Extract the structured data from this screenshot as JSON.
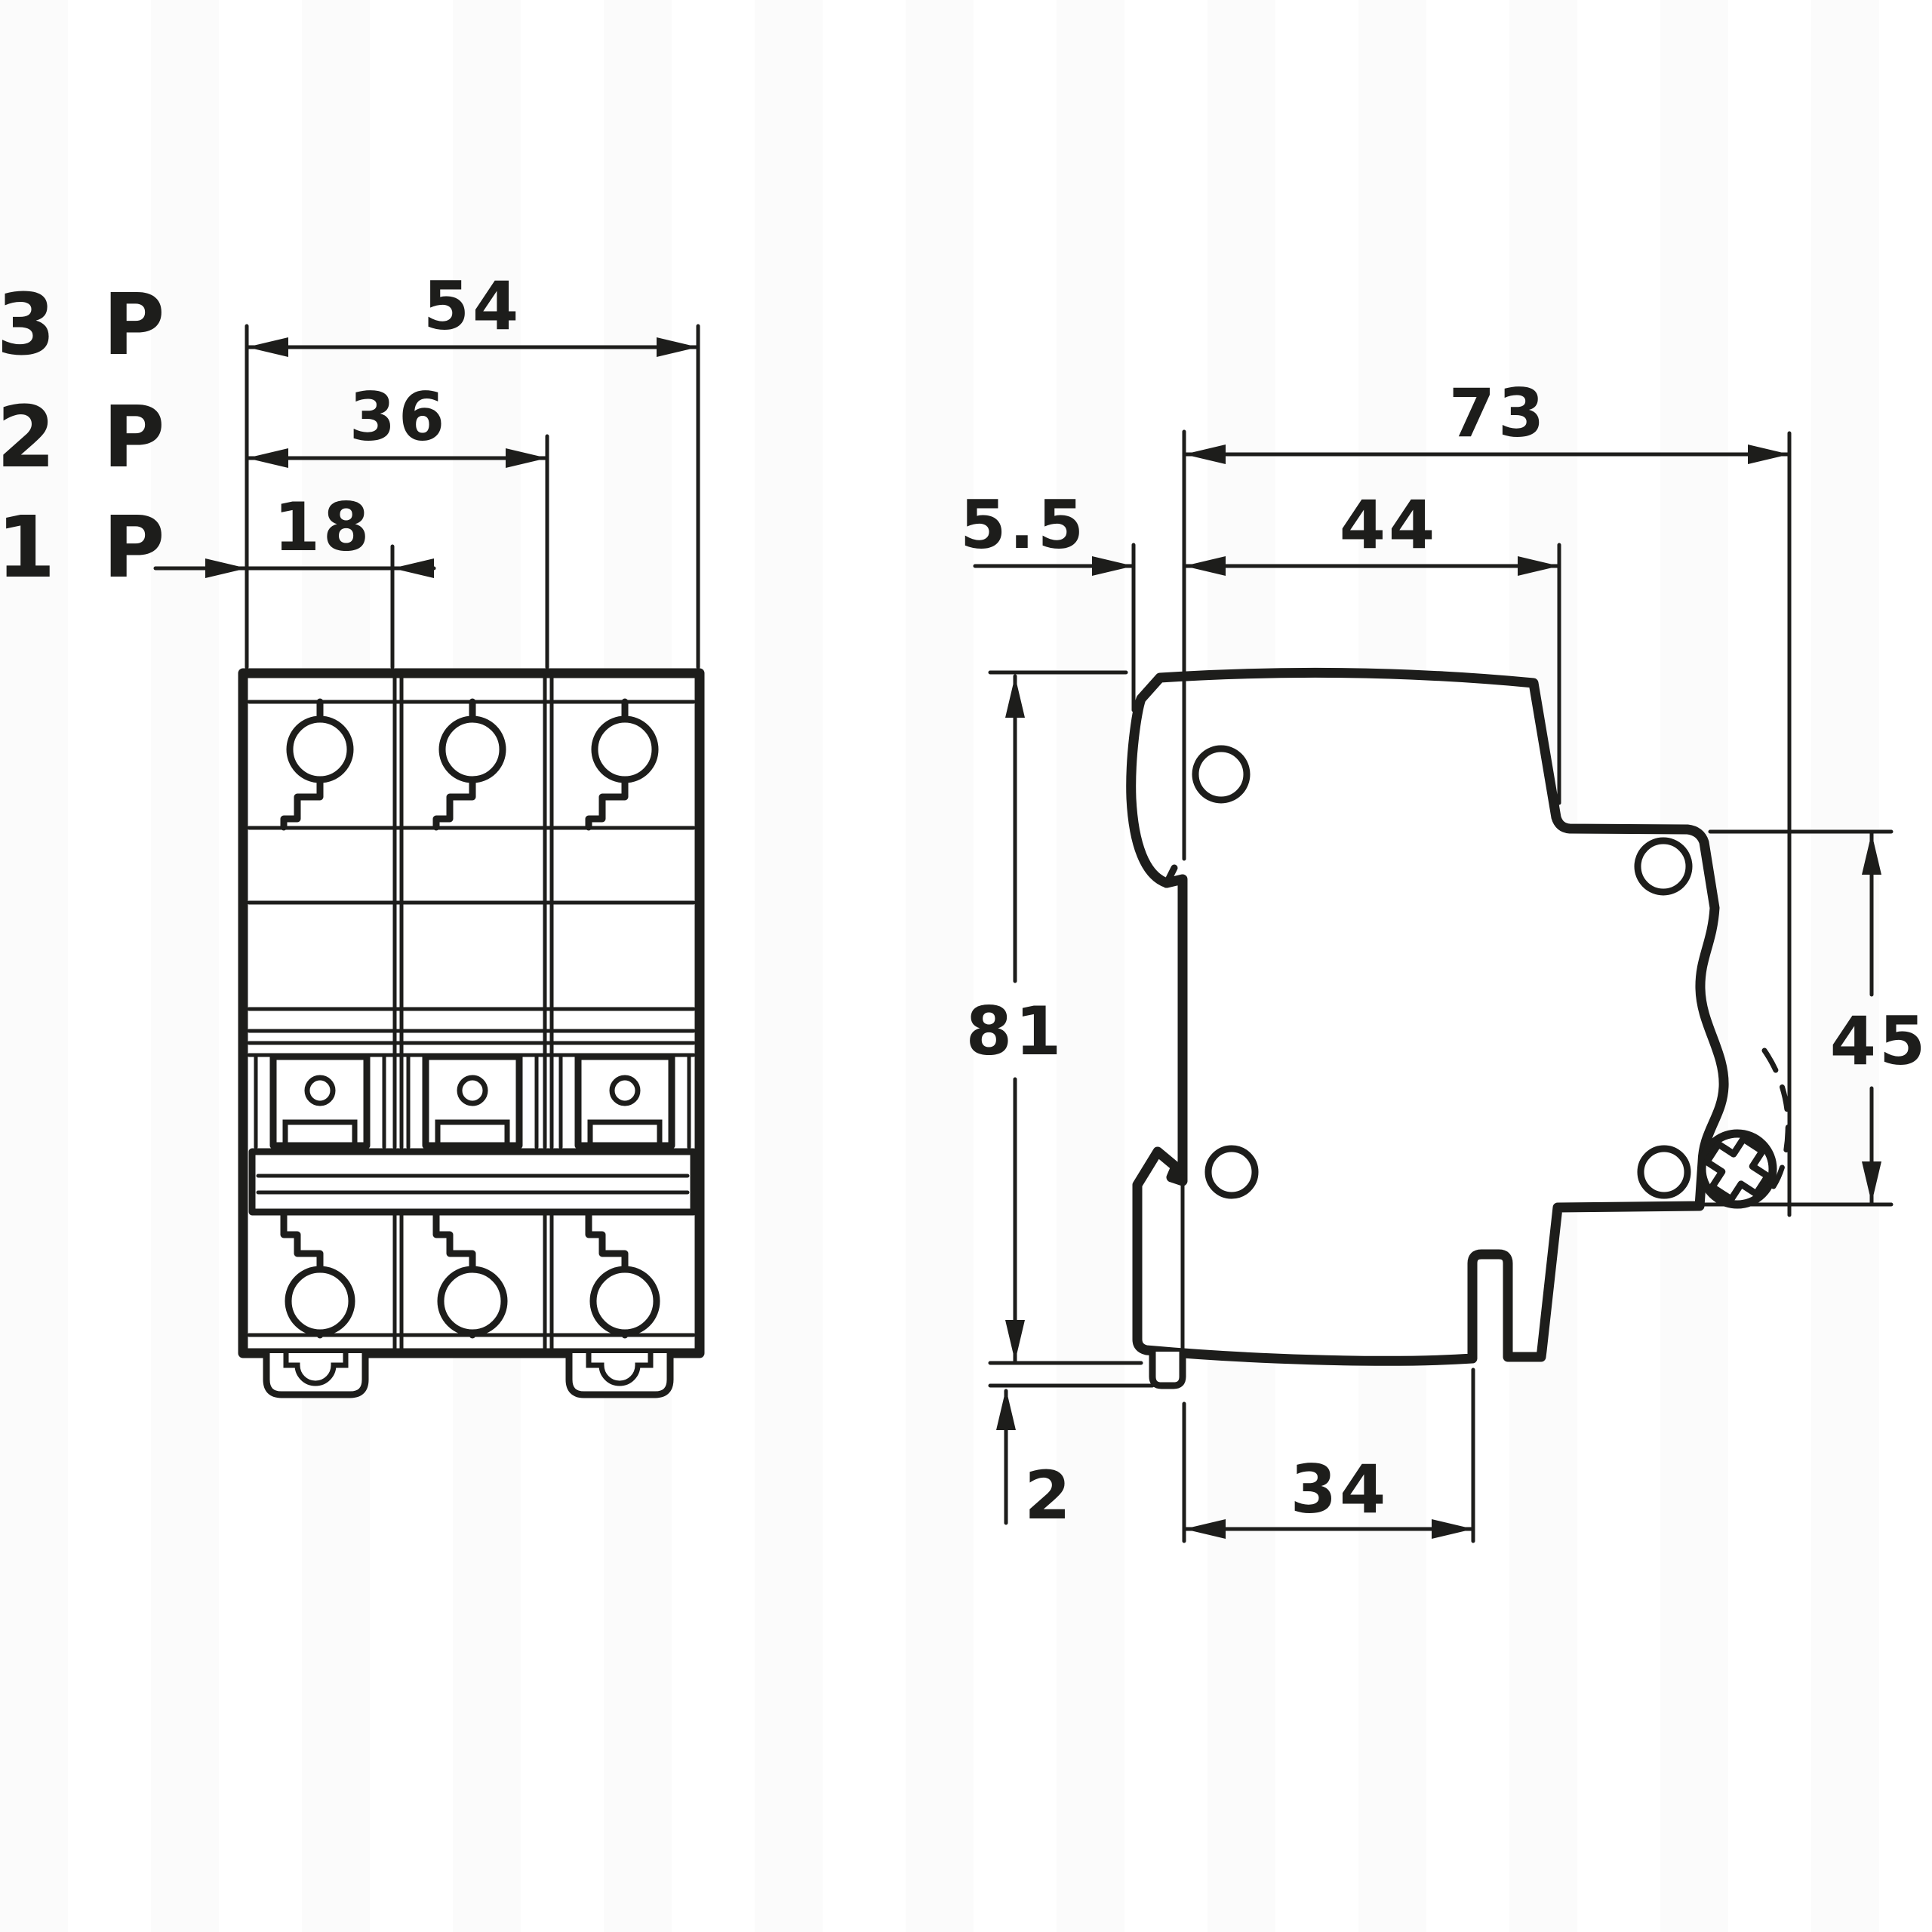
{
  "title": "Modular circuit breaker (MCB) outline dimension drawing — front view and side view",
  "units": "mm",
  "colors": {
    "line": "#1d1d1b",
    "background": "#ffffff"
  },
  "labels": {
    "p3": "3 P",
    "p2": "2 P",
    "p1": "1 P"
  },
  "front_view": {
    "name": "front-view",
    "dim_54": "54",
    "dim_36": "36",
    "dim_18": "18"
  },
  "side_view": {
    "name": "side-view",
    "dim_73": "73",
    "dim_44": "44",
    "dim_5_5": "5.5",
    "dim_81": "81",
    "dim_45": "45",
    "dim_2": "2",
    "dim_34": "34"
  },
  "dimensions_mm": {
    "width_3_pole": 54,
    "width_2_pole": 36,
    "width_1_pole": 18,
    "total_depth": 73,
    "depth_in_front_of_rail": 44,
    "rail_claw_offset": 5.5,
    "height": 81,
    "front_face_height": 45,
    "clip_protrusion": 2,
    "base_depth": 34
  }
}
